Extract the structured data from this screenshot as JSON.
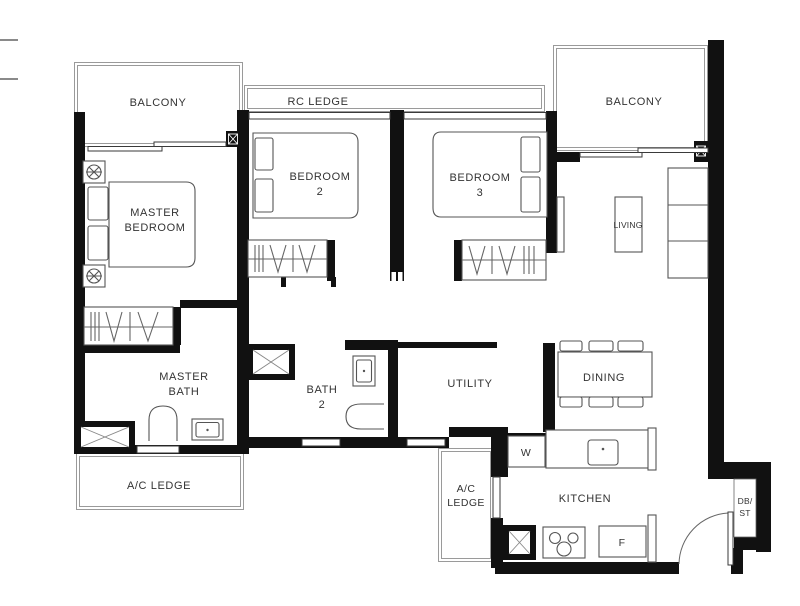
{
  "colors": {
    "wall": "#111111",
    "line": "#555555",
    "thin": "#9a9a9a",
    "text": "#333333",
    "bg": "#ffffff"
  },
  "rooms": {
    "balcony_left": "BALCONY",
    "rc_ledge": "RC LEDGE",
    "balcony_right": "BALCONY",
    "master_bedroom": {
      "line1": "MASTER",
      "line2": "BEDROOM"
    },
    "bedroom_2": {
      "line1": "BEDROOM",
      "line2": "2"
    },
    "bedroom_3": {
      "line1": "BEDROOM",
      "line2": "3"
    },
    "living": "LIVING",
    "dining": "DINING",
    "utility": "UTILITY",
    "master_bath": {
      "line1": "MASTER",
      "line2": "BATH"
    },
    "bath_2": {
      "line1": "BATH",
      "line2": "2"
    },
    "kitchen": "KITCHEN",
    "ac_ledge_left": "A/C LEDGE",
    "ac_ledge_kitchen": {
      "line1": "A/C",
      "line2": "LEDGE"
    },
    "db_st": {
      "line1": "DB/",
      "line2": "ST"
    }
  },
  "appliances": {
    "washer": "W",
    "fridge": "F"
  }
}
